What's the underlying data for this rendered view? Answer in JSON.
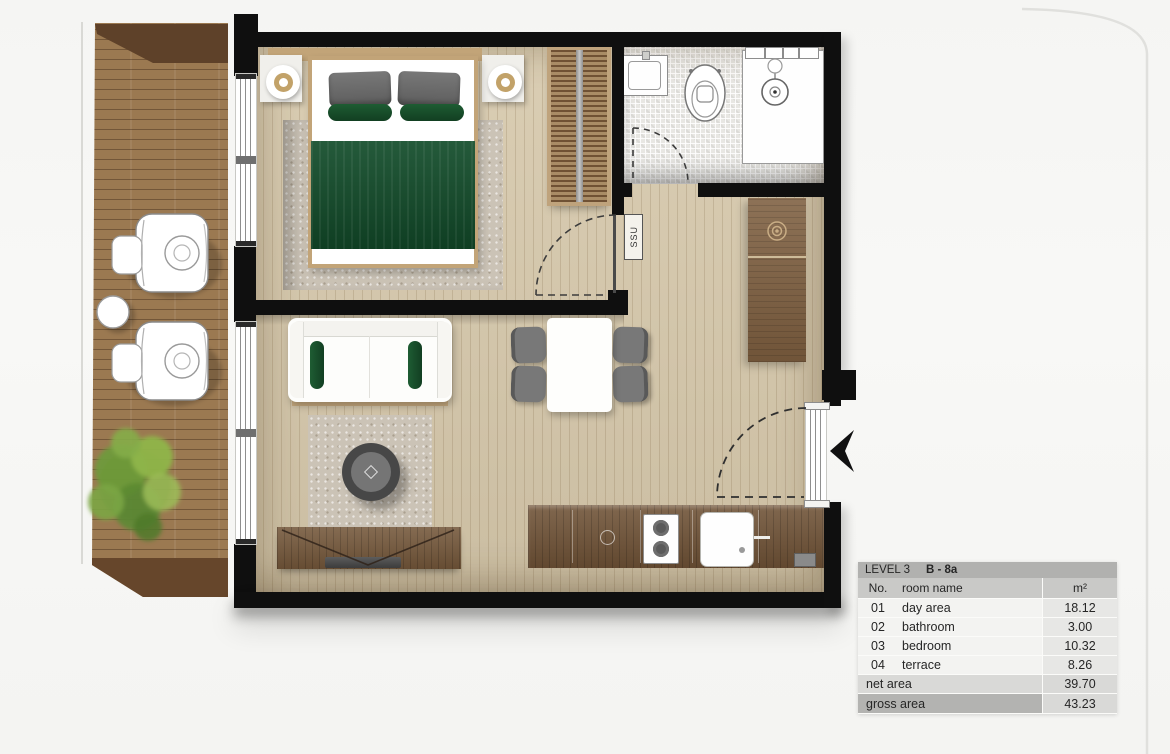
{
  "plan": {
    "shaft_label": "SSU"
  },
  "area_table": {
    "level": "LEVEL 3",
    "unit": "B - 8a",
    "columns": {
      "no": "No.",
      "name": "room name",
      "area": "m²"
    },
    "rows": [
      {
        "no": "01",
        "name": "day area",
        "area": "18.12"
      },
      {
        "no": "02",
        "name": "bathroom",
        "area": "3.00"
      },
      {
        "no": "03",
        "name": "bedroom",
        "area": "10.32"
      },
      {
        "no": "04",
        "name": "terrace",
        "area": "8.26"
      }
    ],
    "net": {
      "label": "net area",
      "value": "39.70"
    },
    "gross": {
      "label": "gross area",
      "value": "43.23"
    }
  },
  "colors": {
    "wall": "#0f0f0f",
    "floor_wood": "#d6c8ab",
    "terrace_wood": "#9b7951",
    "accent_green": "#14532d",
    "table_header": "#b1b1af"
  }
}
